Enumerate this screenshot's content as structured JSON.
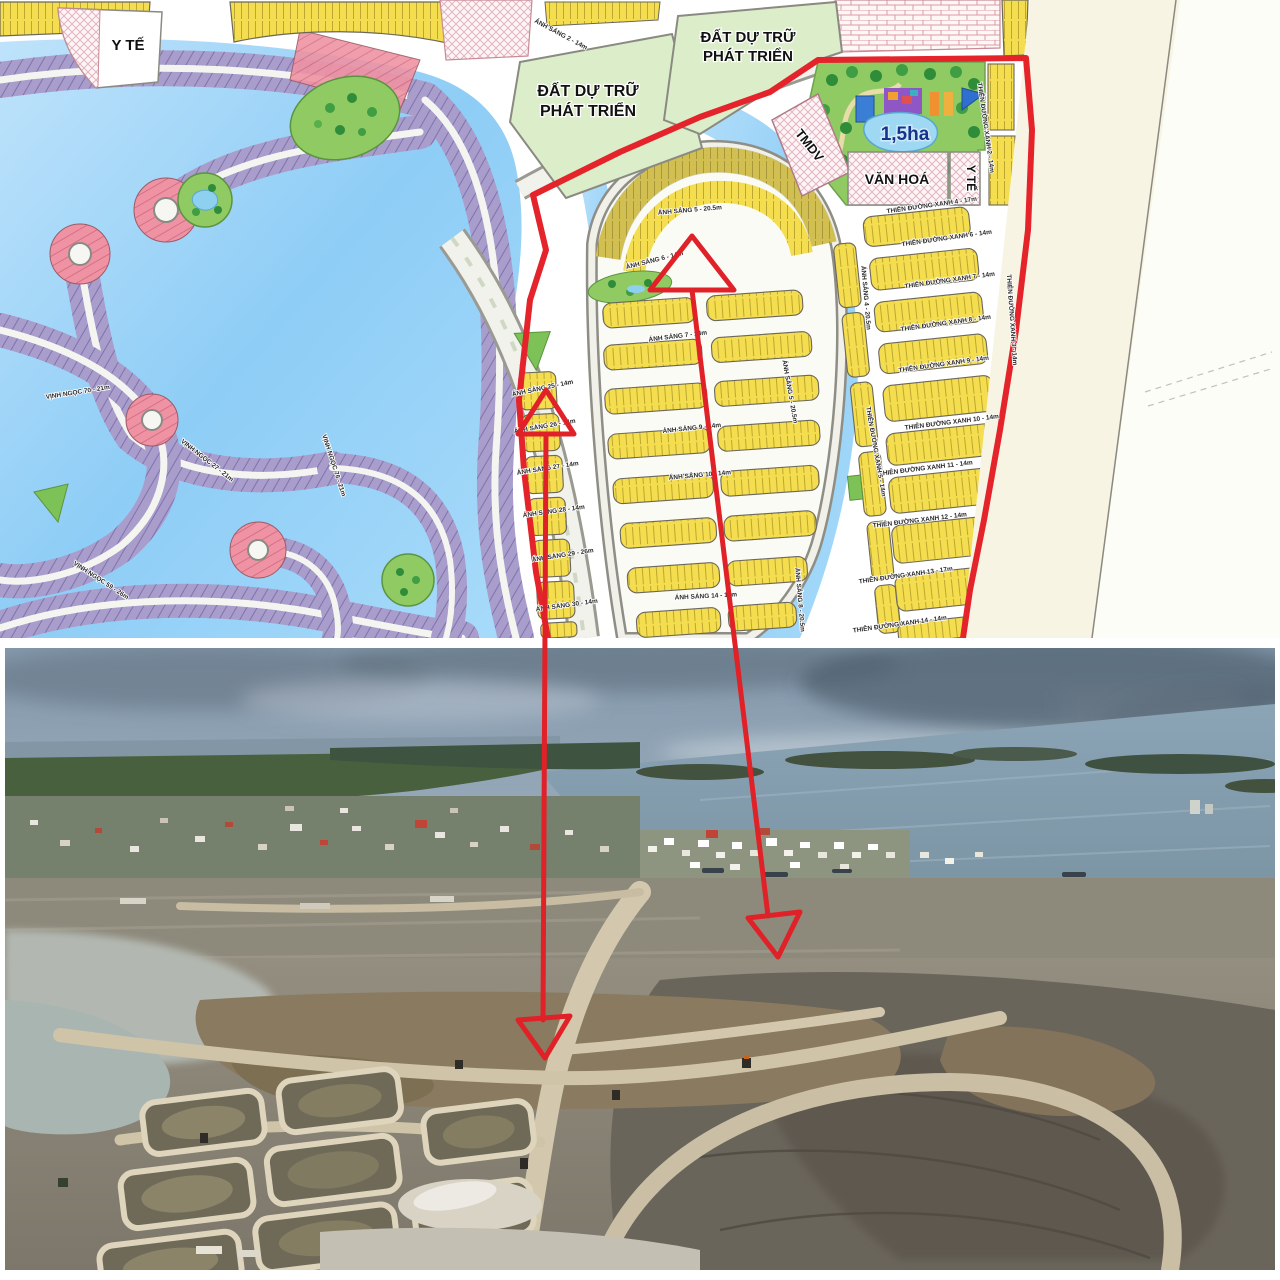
{
  "masterplan": {
    "region_labels": {
      "yte_top_left": "Y TẾ",
      "reserve1_line1": "ĐẤT DỰ TRỮ",
      "reserve1_line2": "PHÁT TRIỂN",
      "reserve2_line1": "ĐẤT DỰ TRỮ",
      "reserve2_line2": "PHÁT TRIỂN",
      "tmdv": "TMDV",
      "van_hoa": "VĂN HOÁ",
      "yte_right": "Y TẾ",
      "park_area": "1,5ha"
    },
    "streets": [
      {
        "text": "VỊNH NGỌC 70 - 21m"
      },
      {
        "text": "VỊNH NGỌC 27 - 21m"
      },
      {
        "text": "VỊNH NGỌC 59 - 26m"
      },
      {
        "text": "VỊNH NGỌC 76 - 21m"
      },
      {
        "text": "ÁNH SÁNG 2 - 14m"
      },
      {
        "text": "ÁNH SÁNG 5 - 20.5m"
      },
      {
        "text": "ÁNH SÁNG 5 - 20.5m"
      },
      {
        "text": "ÁNH SÁNG 4 - 20.5m"
      },
      {
        "text": "ÁNH SÁNG 6 - 14m"
      },
      {
        "text": "ÁNH SÁNG 7 - 14m"
      },
      {
        "text": "ÁNH SÁNG 9 - 14m"
      },
      {
        "text": "ÁNH SÁNG 10 - 14m"
      },
      {
        "text": "ÁNH SÁNG 14 - 14m"
      },
      {
        "text": "ÁNH SÁNG 8 - 20.5m"
      },
      {
        "text": "ÁNH SÁNG 25 - 14m"
      },
      {
        "text": "ÁNH SÁNG 26 - 14m"
      },
      {
        "text": "ÁNH SÁNG 27 - 14m"
      },
      {
        "text": "ÁNH SÁNG 28 - 14m"
      },
      {
        "text": "ÁNH SÁNG 29 - 26m"
      },
      {
        "text": "ÁNH SÁNG 30 - 14m"
      },
      {
        "text": "THIÊN ĐƯỜNG XANH 4 - 17m"
      },
      {
        "text": "THIÊN ĐƯỜNG XANH 6 - 14m"
      },
      {
        "text": "THIÊN ĐƯỜNG XANH 7 - 14m"
      },
      {
        "text": "THIÊN ĐƯỜNG XANH 8 - 14m"
      },
      {
        "text": "THIÊN ĐƯỜNG XANH 9 - 14m"
      },
      {
        "text": "THIÊN ĐƯỜNG XANH 10 - 14m"
      },
      {
        "text": "THIÊN ĐƯỜNG XANH 11 - 14m"
      },
      {
        "text": "THIÊN ĐƯỜNG XANH 12 - 14m"
      },
      {
        "text": "THIÊN ĐƯỜNG XANH 13 - 17m"
      },
      {
        "text": "THIÊN ĐƯỜNG XANH 14 - 14m"
      },
      {
        "text": "THIÊN ĐƯỜNG XANH 2 - 14m"
      },
      {
        "text": "THIÊN ĐƯỜNG XANH 3 - 14m"
      },
      {
        "text": "THIÊN ĐƯỜNG XANH 5 - 14m"
      }
    ],
    "colors": {
      "water": "#8ecdf6",
      "lot_yellow": "#f4dd4e",
      "lot_purple": "#a89dcb",
      "lot_pink": "#ef93a4",
      "reserve_green": "#dcedc9",
      "park_green": "#8fca63",
      "beach_cream": "#f8f4e3",
      "boundary_red": "#e4232b"
    }
  },
  "annotation": {
    "arrow_color": "#e02128",
    "arrows": [
      {
        "name": "site-pointer-left"
      },
      {
        "name": "site-pointer-right"
      }
    ]
  }
}
